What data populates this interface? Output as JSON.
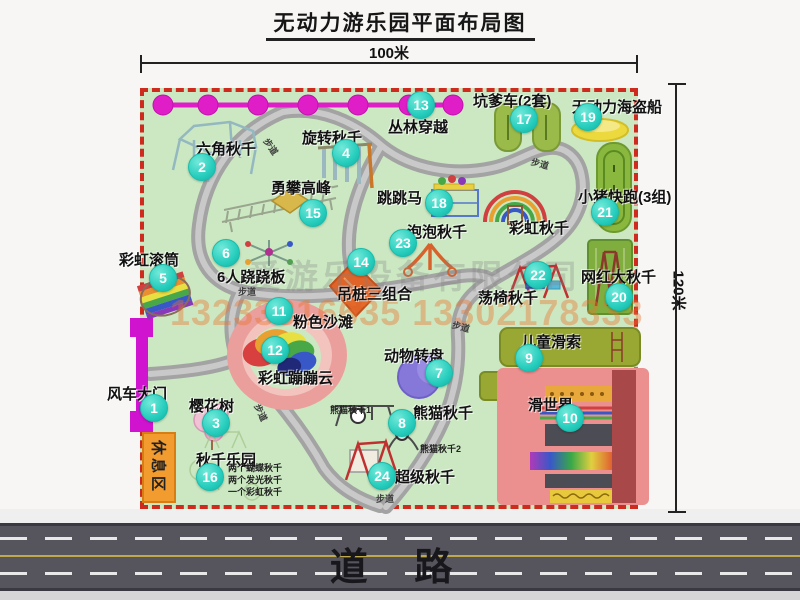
{
  "title": "无动力游乐园平面布局图",
  "dimensions": {
    "top": "100米",
    "right": "120米"
  },
  "road": {
    "label": "道  路"
  },
  "watermark": {
    "company": "爱游乐设备有限公司",
    "phone": "13233816635 13302178333"
  },
  "rest_area": {
    "label": "休息区"
  },
  "colors": {
    "map_bg": "#cbe8c2",
    "border_dashed": "#cf2a1e",
    "marker_teal": "#27cdbd",
    "zipline_magenta": "#e01ec8",
    "gate_magenta": "#cf13cf",
    "road_gray": "#56545c",
    "rest_area_orange": "#f29b2e",
    "beach_pink": "#ea9f9c",
    "path_gray": "#a3a3a3"
  },
  "map_icons": [
    "zipline-icon",
    "gate-icon",
    "hexagon-swing-icon",
    "rotating-swing-icon",
    "climbing-ladder-icon",
    "rainbow-roller-icon",
    "seesaw-spinner-icon",
    "jumping-horse-icon",
    "bubble-swing-tripod-icon",
    "rainbow-swing-arcs-icon",
    "kart-track-icon",
    "pirate-ship-icon",
    "pig-run-track-icon",
    "big-swing-frame-icon",
    "swing-chair-icon",
    "hanging-pile-icon",
    "pink-beach-icon",
    "rainbow-cloud-icon",
    "animal-turntable-icon",
    "panda-swing-icon",
    "super-swing-icon",
    "kids-zipline-icon",
    "slide-world-icon",
    "cherry-tree-icon"
  ],
  "attractions": [
    {
      "num": "1",
      "name": "风车大门",
      "cx": 153,
      "cy": 407,
      "lx": 107,
      "ly": 383
    },
    {
      "num": "2",
      "name": "六角秋千",
      "cx": 201,
      "cy": 166,
      "lx": 196,
      "ly": 138
    },
    {
      "num": "3",
      "name": "樱花树",
      "cx": 215,
      "cy": 422,
      "lx": 189,
      "ly": 395
    },
    {
      "num": "4",
      "name": "旋转秋千",
      "cx": 345,
      "cy": 152,
      "lx": 302,
      "ly": 127
    },
    {
      "num": "5",
      "name": "彩虹滚筒",
      "cx": 162,
      "cy": 277,
      "lx": 119,
      "ly": 249
    },
    {
      "num": "6",
      "name": "6人跷跷板",
      "cx": 225,
      "cy": 252,
      "lx": 217,
      "ly": 266
    },
    {
      "num": "7",
      "name": "动物转盘",
      "cx": 438,
      "cy": 372,
      "lx": 384,
      "ly": 345
    },
    {
      "num": "8",
      "name": "熊猫秋千",
      "cx": 401,
      "cy": 422,
      "lx": 413,
      "ly": 402
    },
    {
      "num": "9",
      "name": "儿童滑索",
      "cx": 528,
      "cy": 357,
      "lx": 521,
      "ly": 331
    },
    {
      "num": "10",
      "name": "滑世界",
      "cx": 569,
      "cy": 417,
      "lx": 528,
      "ly": 394
    },
    {
      "num": "11",
      "name": "粉色沙滩",
      "cx": 278,
      "cy": 310,
      "lx": 293,
      "ly": 311
    },
    {
      "num": "12",
      "name": "彩虹蹦蹦云",
      "cx": 274,
      "cy": 349,
      "lx": 258,
      "ly": 367
    },
    {
      "num": "13",
      "name": "丛林穿越",
      "cx": 420,
      "cy": 104,
      "lx": 388,
      "ly": 116
    },
    {
      "num": "14",
      "name": "吊桩三组合",
      "cx": 360,
      "cy": 261,
      "lx": 337,
      "ly": 283
    },
    {
      "num": "15",
      "name": "勇攀高峰",
      "cx": 312,
      "cy": 212,
      "lx": 271,
      "ly": 177
    },
    {
      "num": "16",
      "name": "秋千乐园",
      "cx": 209,
      "cy": 476,
      "lx": 196,
      "ly": 449
    },
    {
      "num": "17",
      "name": "坑爹车(2套)",
      "cx": 523,
      "cy": 118,
      "lx": 473,
      "ly": 90
    },
    {
      "num": "18",
      "name": "跳跳马",
      "cx": 438,
      "cy": 202,
      "lx": 377,
      "ly": 187
    },
    {
      "num": "19",
      "name": "无动力海盗船",
      "cx": 587,
      "cy": 116,
      "lx": 572,
      "ly": 96
    },
    {
      "num": "20",
      "name": "网红大秋千",
      "cx": 618,
      "cy": 296,
      "lx": 581,
      "ly": 266
    },
    {
      "num": "21",
      "name": "小猪快跑(3组)",
      "cx": 604,
      "cy": 211,
      "lx": 578,
      "ly": 186
    },
    {
      "num": "22",
      "name": "荡椅秋千",
      "cx": 537,
      "cy": 274,
      "lx": 478,
      "ly": 287
    },
    {
      "num": "23",
      "name": "泡泡秋千",
      "cx": 402,
      "cy": 242,
      "lx": 407,
      "ly": 221
    },
    {
      "num": "24",
      "name": "超级秋千",
      "cx": 381,
      "cy": 475,
      "lx": 395,
      "ly": 466
    }
  ],
  "plain_labels": [
    {
      "text": "彩虹秋千",
      "x": 509,
      "y": 217
    }
  ],
  "sub_labels": [
    {
      "text": "熊猫秋千1",
      "x": 330,
      "y": 403
    },
    {
      "text": "熊猫秋千2",
      "x": 420,
      "y": 442
    },
    {
      "text": "两个蝴蝶秋千",
      "x": 228,
      "y": 461
    },
    {
      "text": "两个发光秋千",
      "x": 228,
      "y": 473
    },
    {
      "text": "一个彩虹秋千",
      "x": 228,
      "y": 485
    }
  ],
  "path_labels": [
    {
      "text": "步道",
      "x": 262,
      "y": 140,
      "rot": 55
    },
    {
      "text": "步道",
      "x": 531,
      "y": 157,
      "rot": 15
    },
    {
      "text": "步道",
      "x": 238,
      "y": 285,
      "rot": 0
    },
    {
      "text": "步道",
      "x": 252,
      "y": 406,
      "rot": 65
    },
    {
      "text": "步道",
      "x": 452,
      "y": 320,
      "rot": 15
    },
    {
      "text": "步道",
      "x": 376,
      "y": 492,
      "rot": 0
    }
  ]
}
